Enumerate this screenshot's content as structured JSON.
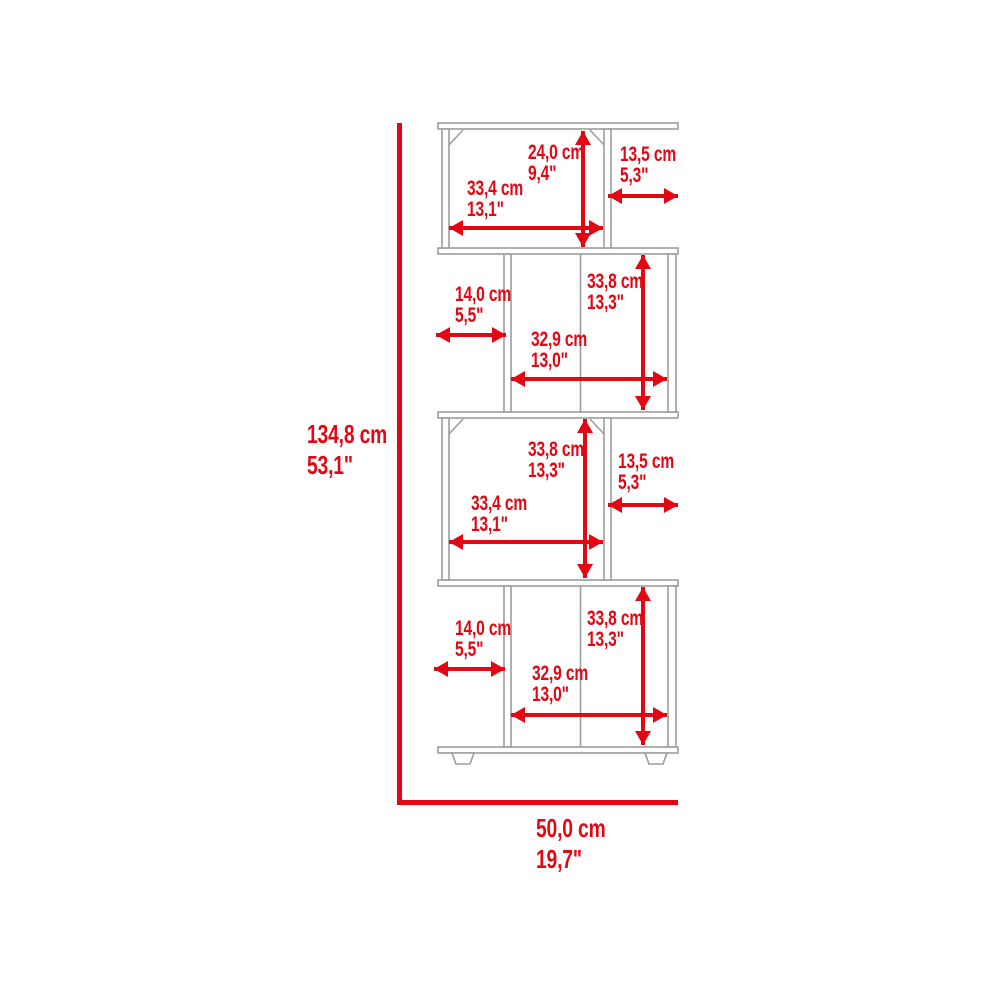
{
  "colors": {
    "dimension_red": "#e30613",
    "outline_gray": "#9d9d9c"
  },
  "overall": {
    "height": {
      "cm": "134,8 cm",
      "inches": "53,1\""
    },
    "width": {
      "cm": "50,0 cm",
      "inches": "19,7\""
    }
  },
  "annotations": [
    {
      "name": "tier1-opening-height",
      "cm": "24,0 cm",
      "inches": "9,4\""
    },
    {
      "name": "tier1-side-depth",
      "cm": "13,5 cm",
      "inches": "5,3\""
    },
    {
      "name": "tier1-opening-width",
      "cm": "33,4 cm",
      "inches": "13,1\""
    },
    {
      "name": "tier2-side-depth",
      "cm": "14,0 cm",
      "inches": "5,5\""
    },
    {
      "name": "tier2-opening-height",
      "cm": "33,8 cm",
      "inches": "13,3\""
    },
    {
      "name": "tier2-opening-width",
      "cm": "32,9 cm",
      "inches": "13,0\""
    },
    {
      "name": "tier3-opening-height",
      "cm": "33,8 cm",
      "inches": "13,3\""
    },
    {
      "name": "tier3-side-depth",
      "cm": "13,5 cm",
      "inches": "5,3\""
    },
    {
      "name": "tier3-opening-width",
      "cm": "33,4 cm",
      "inches": "13,1\""
    },
    {
      "name": "tier4-side-depth",
      "cm": "14,0 cm",
      "inches": "5,5\""
    },
    {
      "name": "tier4-opening-height",
      "cm": "33,8 cm",
      "inches": "13,3\""
    },
    {
      "name": "tier4-opening-width",
      "cm": "32,9 cm",
      "inches": "13,0\""
    }
  ]
}
